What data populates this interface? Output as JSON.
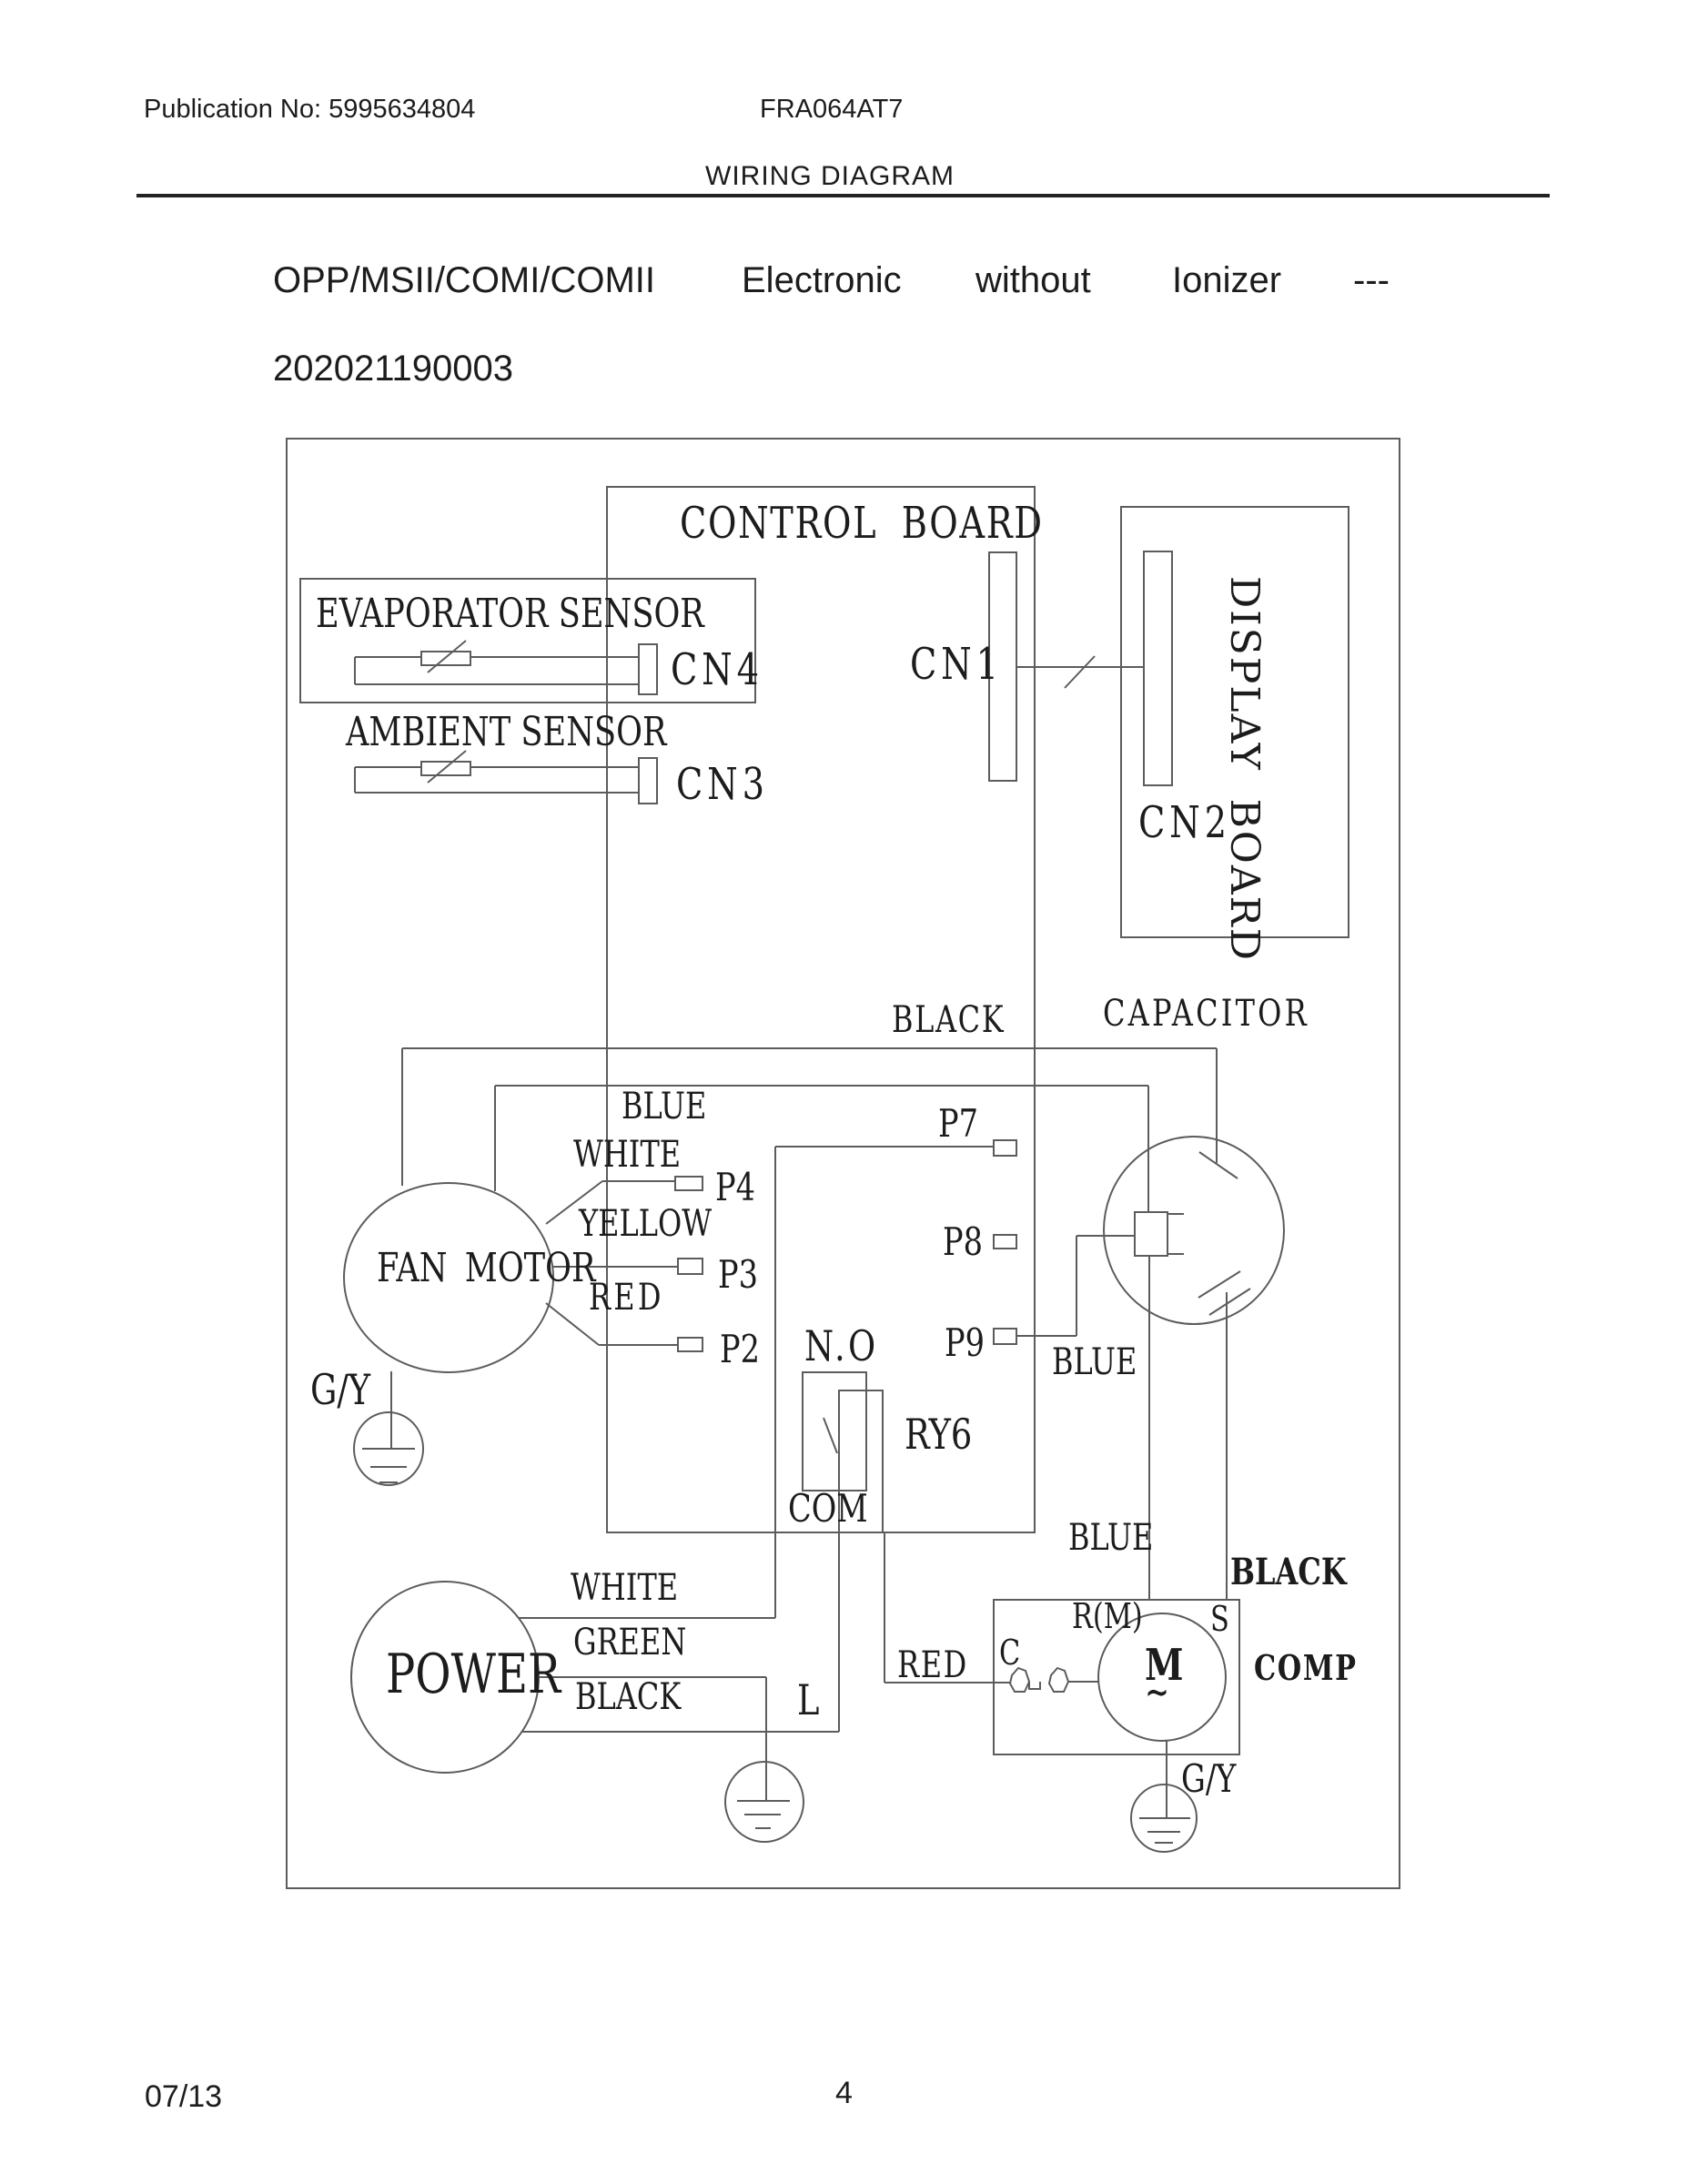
{
  "colors": {
    "ink": "#1c1c1c",
    "line": "#5c5c5c"
  },
  "header": {
    "publication": "Publication No: 5995634804",
    "model": "FRA064AT7",
    "doc_title": "WIRING DIAGRAM"
  },
  "title": {
    "words": [
      "OPP/MSII/COMI/COMII",
      "Electronic",
      "without",
      "Ionizer",
      "---"
    ],
    "code": "202021190003"
  },
  "diagram": {
    "boards": {
      "control": "CONTROL BOARD",
      "display": "DISPLAY BOARD"
    },
    "sensors": {
      "evaporator": "EVAPORATOR SENSOR",
      "ambient": "AMBIENT SENSOR"
    },
    "connectors": {
      "cn1": "CN1",
      "cn2": "CN2",
      "cn3": "CN3",
      "cn4": "CN4",
      "p2": "P2",
      "p3": "P3",
      "p4": "P4",
      "p7": "P7",
      "p8": "P8",
      "p9": "P9"
    },
    "components": {
      "fan_motor": "FAN MOTOR",
      "power": "POWER",
      "capacitor": "CAPACITOR",
      "compressor": "COMP",
      "relay": "RY6",
      "motor_letter": "M",
      "motor_tilde": "∼"
    },
    "relay_contacts": {
      "normally_open": "N.O",
      "common": "COM"
    },
    "comp_terminals": {
      "run": "R(M)",
      "start": "S",
      "common": "C"
    },
    "wires": {
      "fan_black": "BLACK",
      "fan_blue": "BLUE",
      "fan_white": "WHITE",
      "fan_yellow": "YELLOW",
      "fan_red": "RED",
      "fan_ground": "G/Y",
      "cap_blue": "BLUE",
      "comp_blue": "BLUE",
      "comp_black": "BLACK",
      "power_white": "WHITE",
      "power_green": "GREEN",
      "power_black": "BLACK",
      "relay_red": "RED",
      "line_terminal": "L",
      "comp_ground": "G/Y"
    }
  },
  "footer": {
    "date": "07/13",
    "page": "4"
  }
}
